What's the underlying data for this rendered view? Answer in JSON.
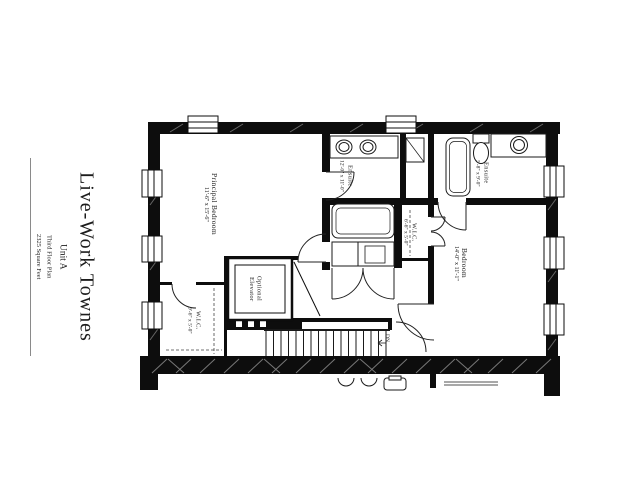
{
  "title_block": {
    "title": "Live-Work Townes",
    "unit": "Unit A",
    "plan": "Third Floor Plan",
    "area": "2325 Square Feet"
  },
  "rooms": {
    "principal_bedroom": {
      "name": "Principal Bedroom",
      "dims": "11'-6\" x 15'-6\""
    },
    "ensuite_primary": {
      "name": "Ensuite",
      "dims": "12'-0\" x 11'-0\""
    },
    "ensuite_secondary": {
      "name": "Ensuite",
      "dims": "5'-8\" x 9'-0\""
    },
    "wic_hall": {
      "name": "W.I.C.",
      "dims": "6'-6\" x 5'-0\""
    },
    "bedroom": {
      "name": "Bedroom",
      "dims": "14'-0\" x 11'-1\""
    },
    "elevator": {
      "name": "Optional Elevator",
      "dims": ""
    },
    "wic_principal": {
      "name": "W.I.C.",
      "dims": "9'-6\" x 5'-0\""
    }
  },
  "stairs": {
    "direction_label": "DN"
  },
  "colors": {
    "wall": "#0d0d0d",
    "line": "#1a1a1a",
    "background": "#ffffff"
  }
}
